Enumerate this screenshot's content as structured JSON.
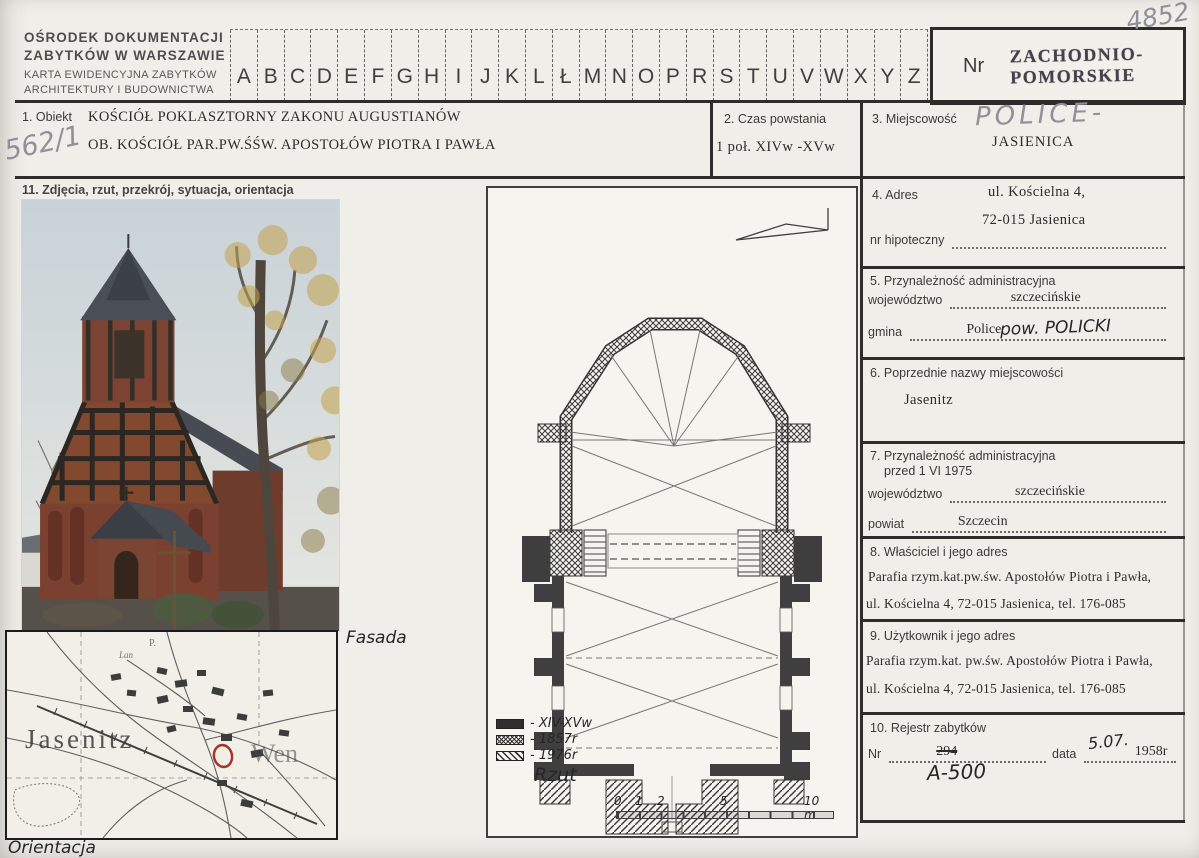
{
  "colors": {
    "marker_red": "#a8322c",
    "pencil_gray": "#90909a",
    "ink_black": "#26262a",
    "paper": "#f0eee9"
  },
  "icons": {
    "north_arrow": "north-arrow",
    "location_marker": "circle-outline"
  },
  "header": {
    "org_line1": "OŚRODEK DOKUMENTACJI",
    "org_line2": "ZABYTKÓW W WARSZAWIE",
    "org_line3": "KARTA EWIDENCYJNA ZABYTKÓW",
    "org_line4": "ARCHITEKTURY I BUDOWNICTWA",
    "letters": [
      "A",
      "B",
      "C",
      "D",
      "E",
      "F",
      "G",
      "H",
      "I",
      "J",
      "K",
      "L",
      "Ł",
      "M",
      "N",
      "O",
      "P",
      "R",
      "S",
      "T",
      "U",
      "V",
      "W",
      "X",
      "Y",
      "Z"
    ],
    "nr_label": "Nr",
    "region_line1": "ZACHODNIO-",
    "region_line2": "POMORSKIE",
    "corner_number": "4852"
  },
  "fields": {
    "f1": {
      "label": "1. Obiekt",
      "line1": "KOŚCIÓŁ POKLASZTORNY ZAKONU AUGUSTIANÓW",
      "line2": "OB. KOŚCIÓŁ PAR.PW.ŚŚW. APOSTOŁÓW PIOTRA I PAWŁA",
      "ref_number": "562/1"
    },
    "f2": {
      "label": "2. Czas powstania",
      "value": "1 poł. XIVw -XVw"
    },
    "f3": {
      "label": "3. Miejscowość",
      "handwritten": "POLICE-",
      "value": "JASIENICA"
    },
    "f4": {
      "label": "4. Adres",
      "line1": "ul. Kościelna 4,",
      "line2": "72-015 Jasienica",
      "sub_label": "nr hipoteczny"
    },
    "f5": {
      "label": "5. Przynależność administracyjna",
      "row1_label": "województwo",
      "row1_value": "szczecińskie",
      "row2_label": "gmina",
      "row2_value": "Police",
      "row2_handwritten": "pow. POLICKI"
    },
    "f6": {
      "label": "6. Poprzednie nazwy miejscowości",
      "value": "Jasenitz"
    },
    "f7": {
      "label_line1": "7. Przynależność administracyjna",
      "label_line2": "przed 1 VI 1975",
      "row1_label": "województwo",
      "row1_value": "szczecińskie",
      "row2_label": "powiat",
      "row2_value": "Szczecin"
    },
    "f8": {
      "label": "8. Właściciel i jego adres",
      "line1": "Parafia rzym.kat.pw.św. Apostołów Piotra i Pawła,",
      "line2": "ul. Kościelna 4, 72-015 Jasienica, tel. 176-085"
    },
    "f9": {
      "label": "9. Użytkownik i jego adres",
      "line1": "Parafia rzym.kat. pw.św. Apostołów Piotra i Pawła,",
      "line2": "ul. Kościelna 4, 72-015 Jasienica, tel. 176-085"
    },
    "f10": {
      "label": "10. Rejestr zabytków",
      "nr_label": "Nr",
      "nr_struck": "294",
      "nr_handwritten": "A-500",
      "data_label": "data",
      "data_handwritten": "5.07.",
      "data_value": "1958r"
    },
    "f11": {
      "label": "11. Zdjęcia, rzut, przekrój, sytuacja, orientacja"
    }
  },
  "photo": {
    "caption": "Fasada"
  },
  "plan": {
    "caption": "Rzut",
    "legend": [
      {
        "style": "solid",
        "label": "- XIV-XVw"
      },
      {
        "style": "crosshatch",
        "label": "- 1857r"
      },
      {
        "style": "diagonal",
        "label": "- 1976r"
      }
    ],
    "scale_ticks": [
      "0",
      "1",
      "2",
      "5",
      "10 m"
    ]
  },
  "map": {
    "caption": "Orientacja",
    "place_label": "Jasenitz",
    "partial_label": "Wen",
    "micro_label1": "P.",
    "micro_label2": "Lan"
  }
}
